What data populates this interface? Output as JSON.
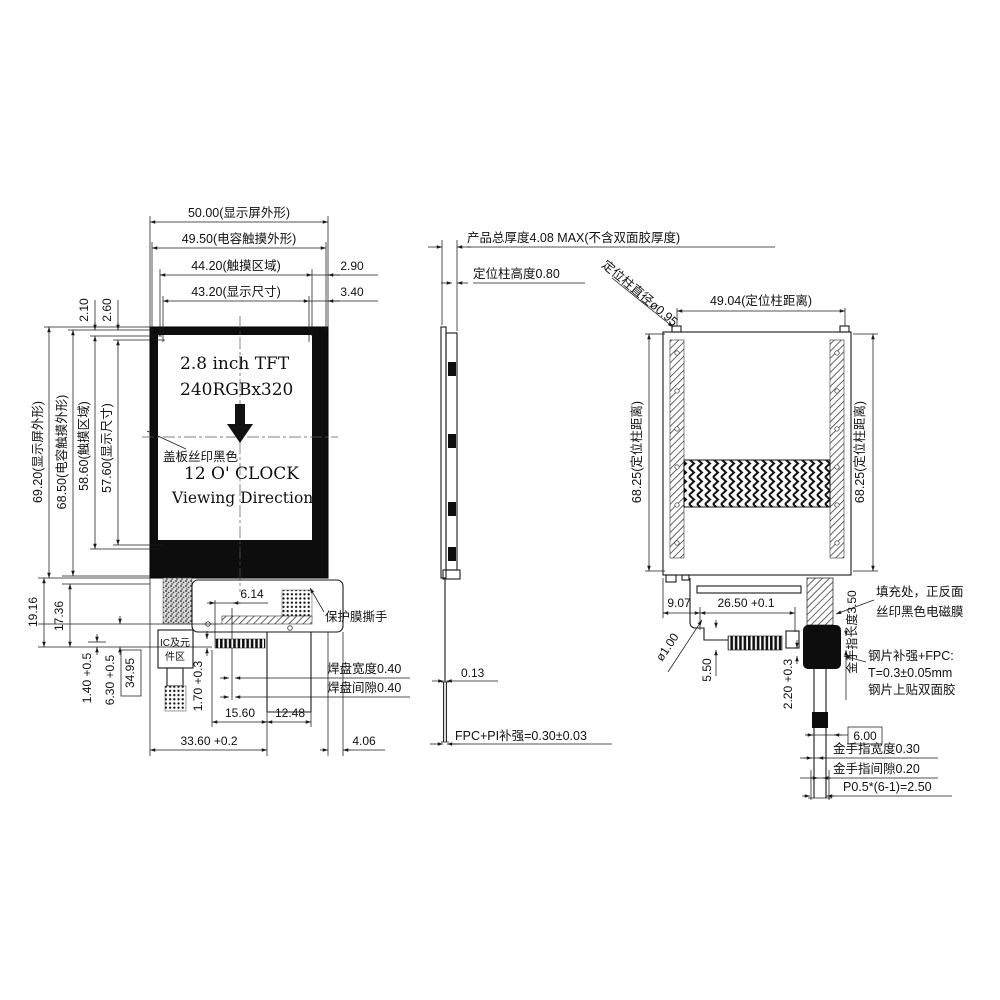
{
  "colors": {
    "ink": "#1a1a1a",
    "background": "#ffffff",
    "bezel": "#0d0d0d"
  },
  "front_view": {
    "top_dims": {
      "outer": "50.00(显示屏外形)",
      "touch_outer": "49.50(电容触摸外形)",
      "touch_area": "44.20(触摸区域)",
      "display_area": "43.20(显示尺寸)",
      "offset_a": "2.90",
      "offset_b": "3.40"
    },
    "left_dims": {
      "outer": "69.20(显示屏外形)",
      "touch_outer": "68.50(电容触摸外形)",
      "touch_area": "58.60(触摸区域)",
      "display_area": "57.60(显示尺寸)",
      "offset_a": "2.10",
      "offset_b": "2.60"
    },
    "screen": {
      "line1": "2.8 inch TFT",
      "line2": "240RGBx320",
      "line3": "12 O' CLOCK",
      "line4": "Viewing Direction",
      "cover_note": "盖板丝印黑色"
    },
    "fpc": {
      "len_a": "19.16",
      "len_b": "17.36",
      "off_a": "1.40 +0.5",
      "off_b": "6.30 +0.5",
      "ref_w": "34.95",
      "pad_len": "1.70 +0.3",
      "ic_line1": "IC及元",
      "ic_line2": "件区",
      "off_c": "6.14",
      "film_tear": "保护膜撕手",
      "pad_width": "焊盘宽度0.40",
      "pad_gap": "焊盘间隙0.40",
      "w_a": "15.60",
      "w_b": "12.48",
      "w_total": "33.60 +0.2",
      "w_c": "4.06"
    }
  },
  "side_view": {
    "thickness": "产品总厚度4.08  MAX(不含双面胶厚度)",
    "post_height": "定位柱高度0.80",
    "fpc_t": "0.13",
    "fpc_note": "FPC+PI补强=0.30±0.03"
  },
  "back_view": {
    "post_dia": "定位柱直径ø0.95",
    "post_dist_h": "49.04(定位柱距离)",
    "post_dist_v_left": "68.25(定位柱距离)",
    "post_dist_v_right": "68.25(定位柱距离)",
    "off_a": "9.07",
    "fpc_w": "26.50 +0.1",
    "hole_dia": "ø1.00",
    "off_b": "5.50",
    "off_c": "2.20 +0.3",
    "finger_len": "金手指长度3.50",
    "fill_note1": "填充处，正反面",
    "fill_note2": "丝印黑色电磁膜",
    "steel_note1": "钢片补强+FPC:",
    "steel_note2": "T=0.3±0.05mm",
    "steel_note3": "钢片上贴双面胶",
    "conn_w": "6.00",
    "finger_width": "金手指宽度0.30",
    "finger_gap": "金手指间隙0.20",
    "finger_pitch": "P0.5*(6-1)=2.50"
  }
}
